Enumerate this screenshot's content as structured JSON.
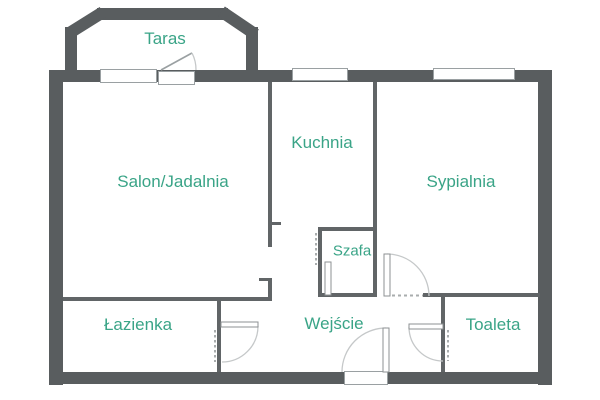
{
  "plan": {
    "rooms": [
      {
        "id": "taras",
        "label": "Taras"
      },
      {
        "id": "salon",
        "label": "Salon/Jadalnia"
      },
      {
        "id": "kuchnia",
        "label": "Kuchnia"
      },
      {
        "id": "sypialnia",
        "label": "Sypialnia"
      },
      {
        "id": "szafa",
        "label": "Szafa"
      },
      {
        "id": "lazienka",
        "label": "Łazienka"
      },
      {
        "id": "wejscie",
        "label": "Wejście"
      },
      {
        "id": "toaleta",
        "label": "Toaleta"
      }
    ]
  },
  "colors": {
    "wall": "#595d5f",
    "interior_wall": "#616567",
    "label": "#3aa487",
    "window_border": "#9aa0a2",
    "door_arc": "#c5c8c9",
    "door_leaf_border": "#8d9193",
    "opening_dash": "#a9adae",
    "background": "#ffffff"
  }
}
